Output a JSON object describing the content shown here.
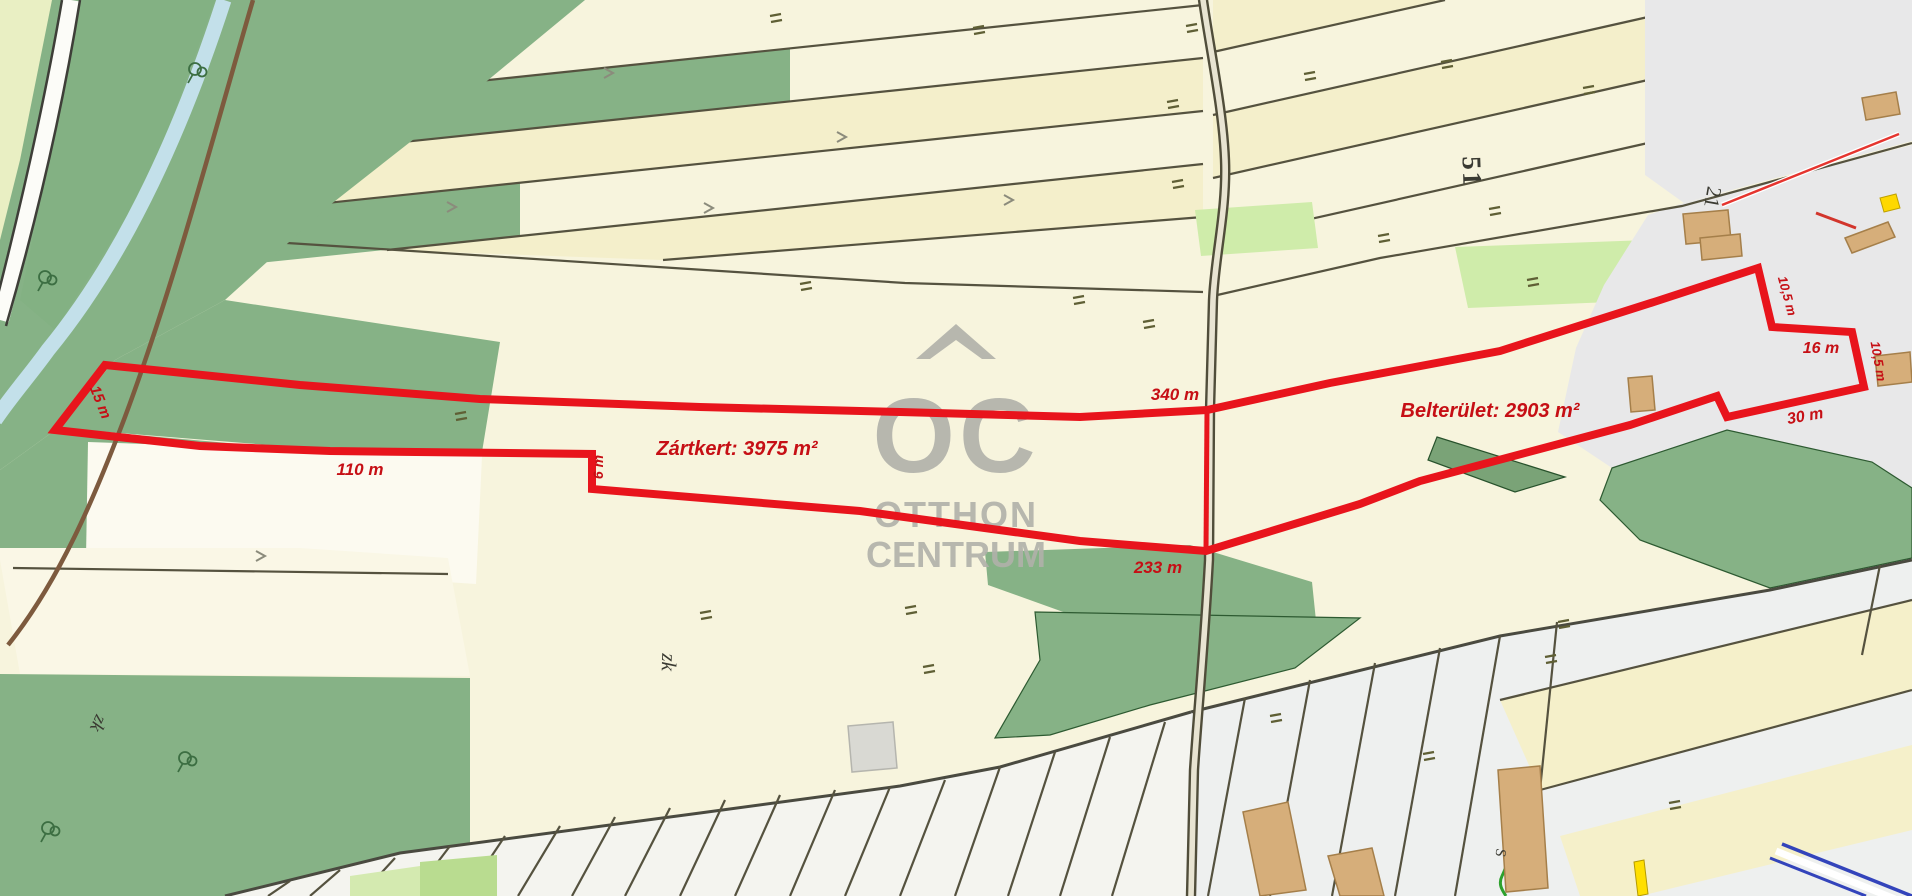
{
  "watermark": {
    "monogram": "OC",
    "brand_line1": "OTTHON",
    "brand_line2": "CENTRUM"
  },
  "outline": {
    "zone_garden_area": "Zártkert: 3975 m²",
    "zone_urban_area": "Belterület: 2903 m²",
    "side_left": "15 m",
    "side_bottom_left": "110 m",
    "side_step": "6 m",
    "side_top": "340 m",
    "side_bottom": "233 m",
    "side_notch": "10,5 m",
    "side_right_top": "16 m",
    "side_right": "10,5 m",
    "side_bottom_right": "30 m"
  },
  "map_labels": {
    "block_number": "51",
    "parcel_number": "21",
    "zone_code_center": "zk",
    "zone_code_left": "zk",
    "street_letter": "S"
  },
  "colors": {
    "outline_red": "#e8141c",
    "label_red": "#c60f15",
    "watermark_gray": "#b1b1aa",
    "parcel_cream": "#f7f4dd",
    "forest_green": "#86b286",
    "urban_gray": "#e8e8e9",
    "water_blue": "#c3e0ea",
    "building_tan": "#d6ae7a"
  }
}
